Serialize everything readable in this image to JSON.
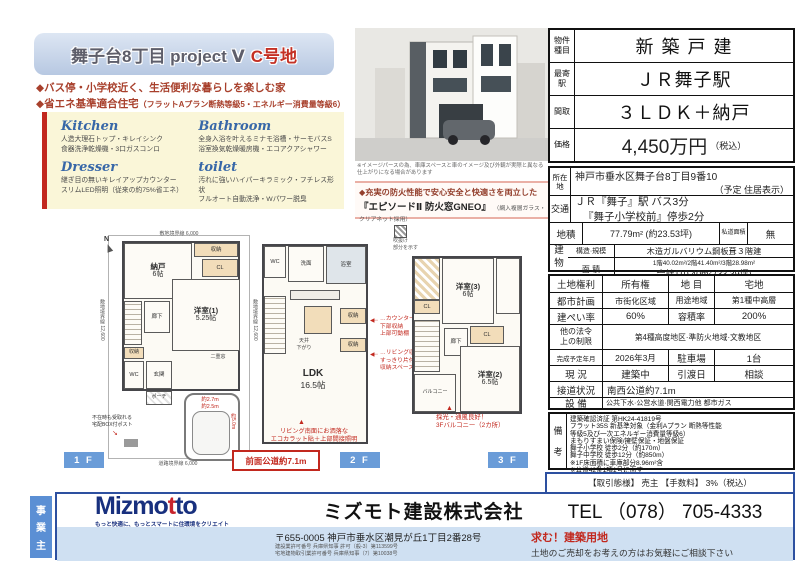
{
  "title": {
    "main": "舞子台8丁目 project Ⅴ",
    "lot": "C号地"
  },
  "bullets": {
    "b1": "◆バス停・小学校近く、生活便利な暮らしを楽しむ家",
    "b2_main": "◆省エネ基準適合住宅",
    "b2_note": "（フラットAプラン断熱等級5・エネルギー消費量等級6）"
  },
  "features": {
    "kitchen_title": "Kitchen",
    "kitchen_line1": "人造大理石トップ・キレイシンク",
    "kitchen_line2": "食器洗浄乾燥機・3口ガスコンロ",
    "bathroom_title": "Bathroom",
    "bathroom_line1": "全身入浴を叶えるミナモ浴槽・サーモバスS",
    "bathroom_line2": "浴室換気乾燥暖房機・エコアクアシャワー",
    "dresser_title": "Dresser",
    "dresser_line1": "継ぎ目の無いキレイアップカウンター",
    "dresser_line2": "スリムLED照明（従来の約75%省エネ）",
    "toilet_title": "toilet",
    "toilet_line1": "汚れに強いハイパーキラミック・フチレス形状",
    "toilet_line2": "フルオート自動洗浄・Wパワー脱臭"
  },
  "photo": {
    "caption1": "※イメージパースの為、車庫スペースと車のイメージ及び外観が実際と異なる",
    "caption2": "仕上がりになる場合があります"
  },
  "fire": {
    "line1": "◆充実の防火性能で安心安全と快適さを両立した",
    "line2": "『エピソードⅡ 防火窓GNEO』",
    "note": "（網入複層ガラス・クリアネット採用）"
  },
  "plans": {
    "legend_l1": "吹抜け",
    "legend_l2": "部分を示す",
    "front_road": "前面公道約7.1m",
    "arrow_left": "◀┈",
    "arrow_up": "▲",
    "f1": {
      "label": "1 F",
      "compass": "N",
      "boundary_top": "敷地境界線 6,000",
      "boundary_left": "敷地境界線 12,600",
      "boundary_right": "敷地境界線 12,600",
      "boundary_bottom": "道路境界線 6,000",
      "nando_name": "納戸",
      "nando_size": "6帖",
      "shuno_top": "収納",
      "cl": "CL",
      "yoshitsu_name": "洋室(1)",
      "yoshitsu_size": "5.25帖",
      "rouka": "廊下",
      "shuno": "収納",
      "wc": "WC",
      "genkan": "玄関",
      "porch": "ポーチ",
      "window_note": "二重窓",
      "car_w1": "約2.7m",
      "car_w2": "約2.5m",
      "car_len": "約5.0m",
      "post1": "不在時も受取れる",
      "post2": "宅配BOX付ポスト"
    },
    "f2": {
      "label": "2 F",
      "wc": "WC",
      "senmen": "洗面",
      "bath": "浴室",
      "ceiling1": "天井",
      "ceiling2": "下がり",
      "shuno1": "収納",
      "shuno2": "収納",
      "ldk_name": "LDK",
      "ldk_size": "16.5帖",
      "ann1_l1": "…カウンター",
      "ann1_l2": "下部収納",
      "ann1_l3": "上部可動棚",
      "ann2_l1": "…リビング収納",
      "ann2_l2": "すっきり片付く",
      "ann2_l3": "収納スペース",
      "ann3_l1": "リビング南面にお洒落な",
      "ann3_l2": "エコカラット貼＋上部間接照明"
    },
    "f3": {
      "label": "3 F",
      "cl1": "CL",
      "room3_name": "洋室(3)",
      "room3_size": "6帖",
      "rouka": "廊下",
      "cl2": "CL",
      "room2_name": "洋室(2)",
      "room2_size": "6.5帖",
      "balcony": "バルコニー",
      "ann_l1": "採光・通風良好！",
      "ann_l2": "3Fバルコニー（2カ所）"
    }
  },
  "spec": {
    "type_label": "物件種目",
    "type": "新築戸建",
    "station_label": "最寄駅",
    "station": "ＪＲ舞子駅",
    "layout_label": "間取",
    "layout": "３ＬＤＫ＋納戸",
    "price_label": "価格",
    "price": "4,450万円",
    "price_note": "（税込）",
    "address_label": "所在地",
    "address": "神戸市垂水区舞子台8丁目9番10",
    "address_note": "（予定 住居表示）",
    "access_label": "交通",
    "access1": "ＪＲ『舞子』駅 バス3分",
    "access2": "『舞子小学校前』停歩2分",
    "land_label": "地積",
    "land": "77.79m² (約23.53坪)",
    "private_label": "私道面積",
    "private": "無",
    "building_label": "建物",
    "structure_label": "構造·規模",
    "structure": "木造ガルバリウム鋼板葺３階建",
    "area_label": "面 積",
    "area1": "1階40.02m²/2階41.40m²/3階28.98m²",
    "area2": "合計110.40m² (33.39坪)",
    "right_label": "土地権利",
    "right": "所有権",
    "mokuteki_label": "地 目",
    "mokuteki": "宅地",
    "city_label": "都市計画",
    "city": "市街化区域",
    "zone_label": "用途地域",
    "zone": "第1種中高層",
    "bcr_label": "建ぺい率",
    "bcr": "60%",
    "far_label": "容積率",
    "far": "200%",
    "law_label1": "他の法令",
    "law_label2": "上の制限",
    "law": "第4種高度地区·準防火地域·文教地区",
    "completion_label": "完成予定年月",
    "completion": "2026年3月",
    "parking_label": "駐車場",
    "parking": "1台",
    "status_label": "現 況",
    "status": "建築中",
    "delivery_label": "引渡日",
    "delivery": "相談",
    "road_label": "接道状況",
    "road": "南西公道約7.1m",
    "utility_label": "設 備",
    "utility": "公共下水·公営水道·関西電力他 都市ガス",
    "remarks_label1": "備",
    "remarks_label2": "考",
    "remarks": [
      "建築確認済証 第HK24-41819号",
      "フラット35S 新基準対象（金利Aプラン 断熱等性能",
      "等級5及び一次エネルギー消費量等級6）",
      "まもりすまい保険/擁壁保証・地盤保証",
      "舞子小学校 徒歩2分（約170m）",
      "舞子中学校 徒歩12分（約850m）",
      "※1F床面積に車庫部分8.96m²含",
      "※公道42条1項1号に面す"
    ]
  },
  "transaction": "【取引態様】 売主 【手数料】 3%（税込）",
  "footer": {
    "owner1": "事",
    "owner2": "業",
    "owner3": "主",
    "logo_a": "Mizmo",
    "logo_b": "t",
    "logo_c": "to",
    "tagline": "もっと快適に、もっとスマートに住環境をクリエイト",
    "company": "ミズモト建設株式会社",
    "tel": "TEL （078） 705-4333",
    "postal": "〒655-0005 神戸市垂水区潮見が丘1丁目2番28号",
    "license1": "建設業許可番号 兵庫県知事 許可（般-3）第113599号",
    "license2": "宅地建物取引業許可番号 兵庫県知事（7）第10038号",
    "recruit": "求む！建築用地",
    "consult": "土地のご売却をお考えの方はお気軽にご相談下さい"
  }
}
